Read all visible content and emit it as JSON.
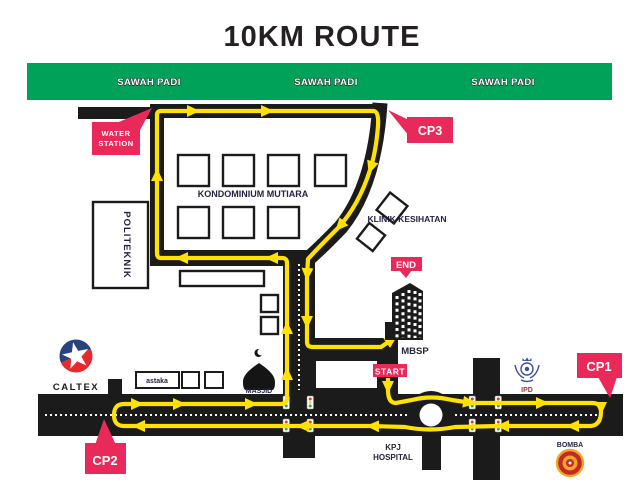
{
  "title": "10KM ROUTE",
  "banner": {
    "labels": [
      "SAWAH PADI",
      "SAWAH PADI",
      "SAWAH PADI"
    ]
  },
  "markers": {
    "cp1": "CP1",
    "cp2": "CP2",
    "cp3": "CP3",
    "start": "START",
    "end": "END",
    "water_station_line1": "WATER",
    "water_station_line2": "STATION"
  },
  "places": {
    "kondominium": "KONDOMINIUM MUTIARA",
    "politeknik": "POLITEKNIK",
    "klinik": "KLINIK KESIHATAN",
    "mbsp": "MBSP",
    "masjid": "MASJID",
    "astaka": "astaka",
    "caltex": "CALTEX",
    "kpj_line1": "KPJ",
    "kpj_line2": "HOSPITAL",
    "ipd": "IPD",
    "bomba": "BOMBA"
  },
  "colors": {
    "banner_green": "#00A259",
    "marker_red": "#E9295A",
    "route_yellow": "#FFE204",
    "road_black": "#1B1B1B",
    "label_navy": "#23233E"
  }
}
